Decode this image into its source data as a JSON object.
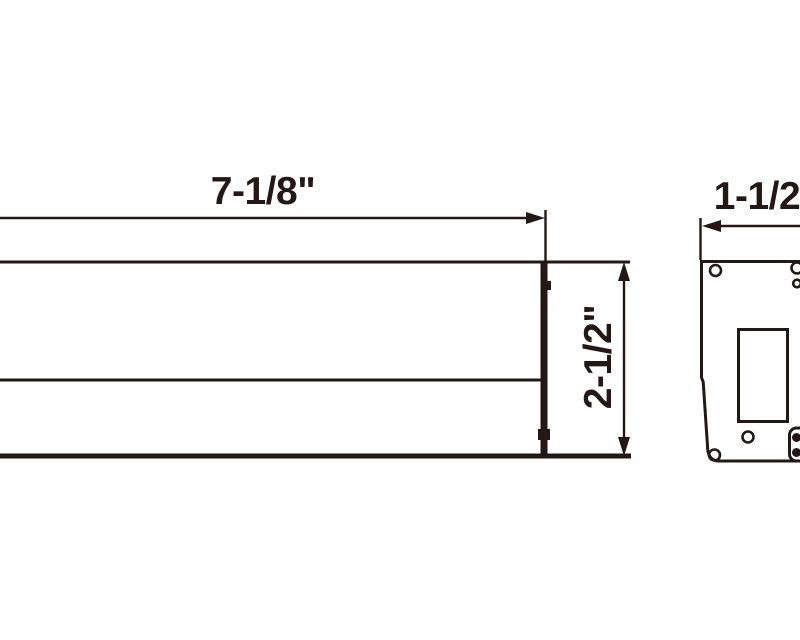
{
  "drawing": {
    "type": "technical-dimension-drawing",
    "colors": {
      "ink": "#231815",
      "background": "#ffffff"
    },
    "front_view": {
      "name": "front-elevation",
      "width_label": "7-1/8\"",
      "height_label": "2-1/2\""
    },
    "side_view": {
      "name": "side-profile",
      "width_label": "1-1/2\""
    }
  }
}
